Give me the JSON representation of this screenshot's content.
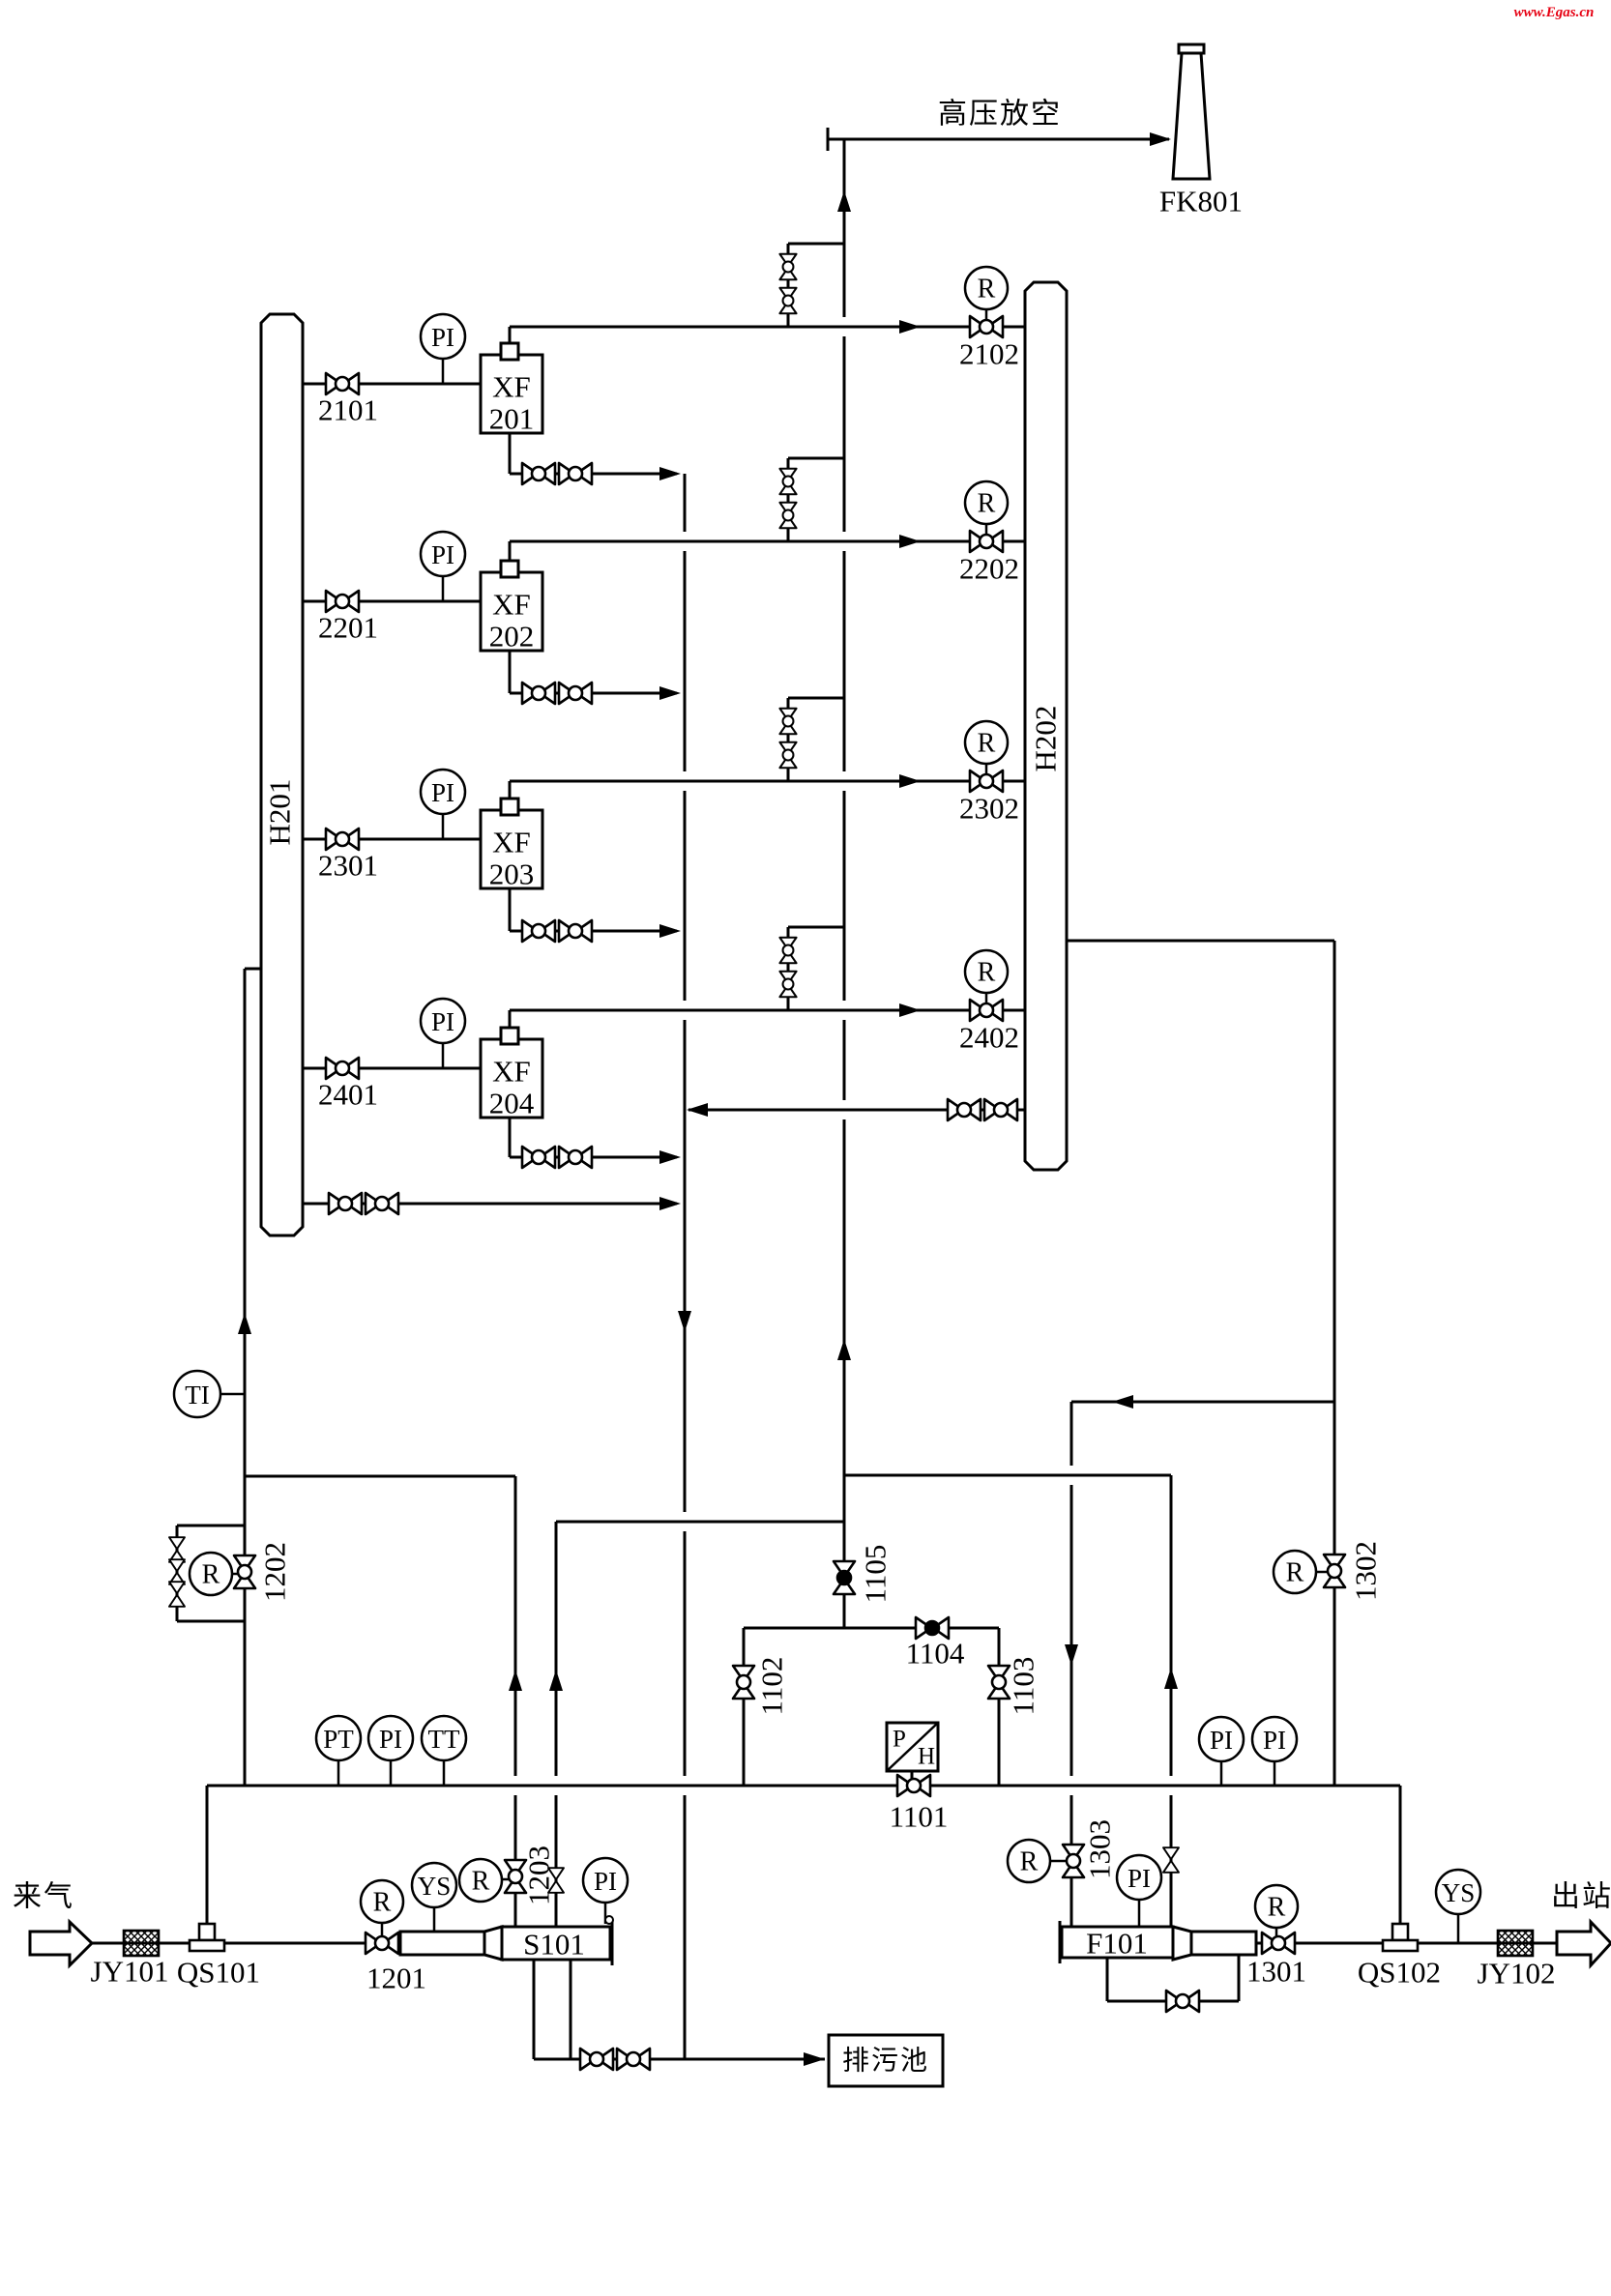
{
  "watermark": {
    "text": "www.Egas.cn",
    "color": "#e60012"
  },
  "texts": {
    "vent_header": "高压放空",
    "inlet": "来气",
    "outlet": "出站",
    "drain_pool": "排污池"
  },
  "equipment": {
    "flare": "FK801",
    "h201": "H201",
    "h202": "H202",
    "s101": "S101",
    "f101": "F101",
    "jy101": "JY101",
    "qs101": "QS101",
    "jy102": "JY102",
    "qs102": "QS102"
  },
  "runs": [
    {
      "feed_valve": "2101",
      "outlet_valve": "2102",
      "heater_prefix": "XF",
      "heater_num": "201"
    },
    {
      "feed_valve": "2201",
      "outlet_valve": "2202",
      "heater_prefix": "XF",
      "heater_num": "202"
    },
    {
      "feed_valve": "2301",
      "outlet_valve": "2302",
      "heater_prefix": "XF",
      "heater_num": "203"
    },
    {
      "feed_valve": "2401",
      "outlet_valve": "2402",
      "heater_prefix": "XF",
      "heater_num": "204"
    }
  ],
  "valves": {
    "v1101": "1101",
    "v1102": "1102",
    "v1103": "1103",
    "v1104": "1104",
    "v1105": "1105",
    "v1201": "1201",
    "v1202": "1202",
    "v1203": "1203",
    "v1301": "1301",
    "v1302": "1302",
    "v1303": "1303"
  },
  "symbols": {
    "r": "R",
    "pi": "PI",
    "pt": "PT",
    "tt": "TT",
    "ti": "TI",
    "ys": "YS",
    "p": "P",
    "h": "H"
  }
}
